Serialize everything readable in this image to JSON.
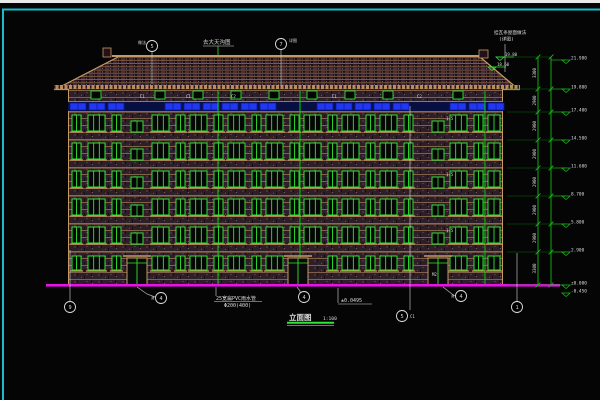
{
  "window_title": "",
  "colors": {
    "background": "#050505",
    "frame_cyan": "#17bccd",
    "top_strip_white": "#e9e9e9",
    "cad_green": "#2ee62e",
    "dim_green": "#18b818",
    "tan": "#c49a62",
    "roof_tan": "#a87c50",
    "blue_panel": "#2238f0",
    "blue_panel_dark": "#0a18a0",
    "ground_magenta": "#e612e6",
    "text_white": "#dcdcdc",
    "wall_dark": "#2e1e28",
    "roof_dark": "#1a0e14"
  },
  "drawing": {
    "building": {
      "left": 68,
      "right": 503,
      "eave": 89,
      "ridge": 57,
      "ridge_l": 118,
      "ridge_r": 480,
      "roof_l": 56,
      "roof_r": 518,
      "ground": 285
    },
    "floor_lines": [
      112,
      140,
      168,
      196,
      224,
      252
    ],
    "window_rows": [
      115,
      143,
      171,
      199,
      227
    ],
    "bottom_row_y": 256,
    "cols": [
      [
        72,
        9
      ],
      [
        88,
        17
      ],
      [
        112,
        9
      ],
      [
        152,
        17
      ],
      [
        176,
        9
      ],
      [
        190,
        17
      ],
      [
        214,
        9
      ],
      [
        228,
        17
      ],
      [
        252,
        9
      ],
      [
        266,
        17
      ],
      [
        290,
        9
      ],
      [
        304,
        17
      ],
      [
        328,
        9
      ],
      [
        342,
        17
      ],
      [
        366,
        9
      ],
      [
        380,
        17
      ],
      [
        404,
        9
      ],
      [
        450,
        17
      ],
      [
        474,
        9
      ],
      [
        488,
        12
      ]
    ],
    "stair_cols": [
      131,
      432
    ],
    "stair_row_ys": [
      121,
      149,
      177,
      205,
      233
    ],
    "doors": [
      [
        127,
        20
      ],
      [
        288,
        20
      ],
      [
        428,
        20
      ]
    ],
    "door_zones": [
      [
        126,
        149
      ],
      [
        286,
        309
      ],
      [
        426,
        449
      ]
    ],
    "downpipes": [
      218,
      300,
      485
    ],
    "blue_band": {
      "y": 103,
      "h": 7,
      "x0": 70,
      "x1": 500,
      "panel_w": 16,
      "step": 19,
      "skip": [
        [
          128,
          150
        ],
        [
          282,
          300
        ],
        [
          424,
          448
        ]
      ]
    },
    "chimneys": [
      [
        103,
        48,
        8,
        9
      ],
      [
        479,
        50,
        9,
        8
      ]
    ],
    "facade_labels": [
      {
        "x": 140,
        "y": 98,
        "t": "C1"
      },
      {
        "x": 186,
        "y": 98,
        "t": "C1"
      },
      {
        "x": 231,
        "y": 98,
        "t": "C2"
      },
      {
        "x": 332,
        "y": 98,
        "t": "C1"
      },
      {
        "x": 417,
        "y": 98,
        "t": "C2"
      },
      {
        "x": 446,
        "y": 120,
        "t": "1.5"
      },
      {
        "x": 446,
        "y": 176,
        "t": "1.5"
      },
      {
        "x": 446,
        "y": 232,
        "t": "1.5"
      },
      {
        "x": 432,
        "y": 276,
        "t": "M2"
      }
    ]
  },
  "dims": {
    "chain_x1": 538,
    "chain_x2": 551,
    "levels": [
      57,
      89,
      112,
      140,
      168,
      196,
      224,
      252,
      285
    ],
    "segment_values": [
      "3300",
      "2900",
      "2900",
      "2900",
      "2900",
      "2900",
      "2900",
      "3300"
    ],
    "flags": [
      {
        "y": 60,
        "v": "21.980"
      },
      {
        "y": 89,
        "v": "19.800"
      },
      {
        "y": 112,
        "v": "17.400"
      },
      {
        "y": 140,
        "v": "14.500"
      },
      {
        "y": 168,
        "v": "11.600"
      },
      {
        "y": 196,
        "v": "8.700"
      },
      {
        "y": 224,
        "v": "5.800"
      },
      {
        "y": 252,
        "v": "2.900"
      },
      {
        "y": 285,
        "v": "±0.000"
      },
      {
        "y": 293,
        "v": "-0.450"
      }
    ],
    "roof_flags": [
      {
        "x": 500,
        "y": 57,
        "v": "19.80"
      },
      {
        "x": 492,
        "y": 67,
        "v": "18.60"
      }
    ]
  },
  "annotations": {
    "bubbles": [
      {
        "x": 70,
        "y": 307,
        "l": "9"
      },
      {
        "x": 517,
        "y": 307,
        "l": "1"
      },
      {
        "x": 161,
        "y": 298,
        "l": "4"
      },
      {
        "x": 461,
        "y": 296,
        "l": "4"
      },
      {
        "x": 402,
        "y": 316,
        "l": "5"
      },
      {
        "x": 304,
        "y": 297,
        "l": "4"
      },
      {
        "x": 152,
        "y": 46,
        "l": "5"
      },
      {
        "x": 281,
        "y": 44,
        "l": "7"
      }
    ],
    "bubble_texts": [
      {
        "x": 146,
        "y": 44,
        "t": "做法",
        "anchor": "end"
      },
      {
        "x": 289,
        "y": 42,
        "t": "详图",
        "anchor": "start"
      },
      {
        "x": 154,
        "y": 300,
        "t": "M",
        "anchor": "end"
      },
      {
        "x": 454,
        "y": 298,
        "t": "M",
        "anchor": "end"
      },
      {
        "x": 410,
        "y": 318,
        "t": "C1",
        "anchor": "start"
      }
    ],
    "leaders_white": [
      [
        137,
        287,
        147,
        294,
        155,
        297
      ],
      [
        443,
        287,
        452,
        294,
        455,
        296
      ],
      [
        297,
        287,
        300,
        291,
        300,
        293
      ],
      [
        410,
        106,
        410,
        310
      ],
      [
        70,
        250,
        70,
        301
      ],
      [
        517,
        253,
        517,
        301
      ],
      [
        152,
        52,
        152,
        84
      ],
      [
        281,
        50,
        281,
        86
      ],
      [
        505,
        44,
        505,
        72
      ],
      [
        216,
        287,
        216,
        296
      ],
      [
        338,
        288,
        338,
        303
      ]
    ],
    "leaders_green": [
      [
        218,
        46,
        218,
        56
      ]
    ]
  },
  "texts": {
    "top_center_note": "去大天沟图",
    "roof_note_line1": "挂瓦条屋面做法",
    "roof_note_line2": "(详图)",
    "pvc_note_line1": "25宽扁PVC雨水管",
    "pvc_note_line2": "Φ200(400)",
    "level_note": "±0.0495",
    "title": "立面图",
    "title_scale": "1:100"
  }
}
